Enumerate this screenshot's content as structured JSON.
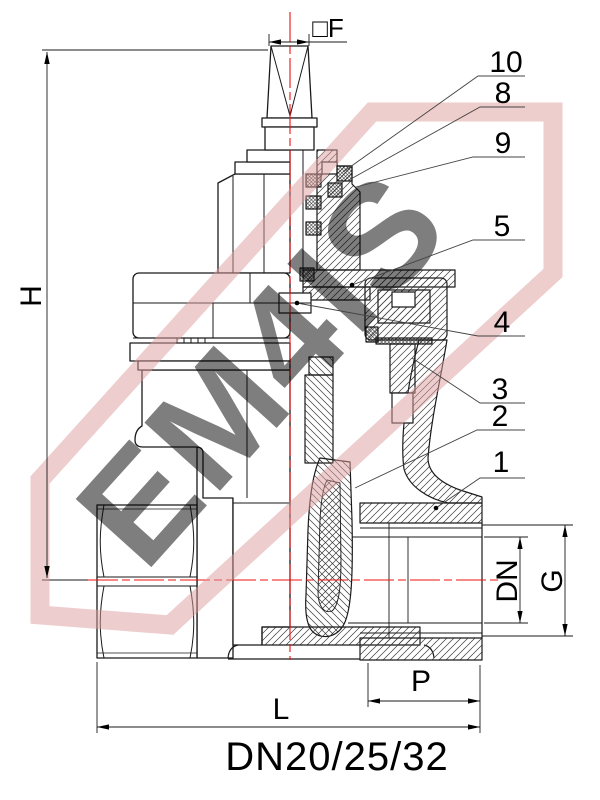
{
  "drawing": {
    "title": "DN20/25/32",
    "watermark": {
      "text": "EM4IS"
    },
    "dims": {
      "height_label": "H",
      "stem_square_label": "□F",
      "length_label": "L",
      "port_depth_label": "P",
      "thread_label": "G",
      "bore_label": "DN"
    },
    "callouts": {
      "c10": "10",
      "c8": "8",
      "c9": "9",
      "c5": "5",
      "c4": "4",
      "c3": "3",
      "c2": "2",
      "c1": "1"
    },
    "colors": {
      "centerline": "#ee1111",
      "watermark": "#dd9c9c",
      "line": "#1a1a1a"
    }
  }
}
